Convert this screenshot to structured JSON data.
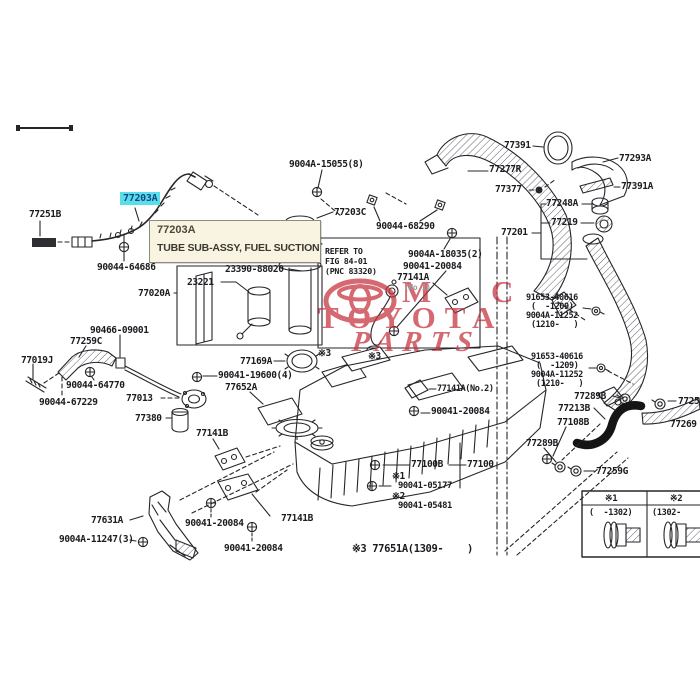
{
  "diagram": {
    "highlight_label": {
      "text": "77203A",
      "bg": "#59dfe8",
      "fg": "#16418f"
    },
    "tooltip": {
      "part_no": "77203A",
      "description": "TUBE SUB-ASSY, FUEL SUCTION"
    },
    "refer_note": [
      "REFER TO",
      "FIG 84-01",
      "(PNC 83320)"
    ],
    "footnote": {
      "marker": "※3",
      "text": " 77651A(1309-    )"
    },
    "watermark": {
      "mc": "M C",
      "toyota": "TOYOTA",
      "parts": "PARTS",
      "color": "#c5303c"
    },
    "ref_table": {
      "headers": [
        "※1",
        "※2"
      ],
      "ranges": [
        "(  -1302)",
        "(1302-"
      ],
      "parts": [
        "bolt-short",
        "bolt-long"
      ]
    },
    "labels": [
      {
        "t": "77251B",
        "x": 29,
        "y": 210
      },
      {
        "t": "90044-64686",
        "x": 97,
        "y": 263
      },
      {
        "t": "23221",
        "x": 187,
        "y": 278
      },
      {
        "t": "23390-88020",
        "x": 225,
        "y": 265
      },
      {
        "t": "77020A",
        "x": 138,
        "y": 289
      },
      {
        "t": "9004A-15055(8)",
        "x": 289,
        "y": 160
      },
      {
        "t": "77203C",
        "x": 334,
        "y": 208
      },
      {
        "t": "90044-68290",
        "x": 376,
        "y": 222
      },
      {
        "t": "9004A-18035(2)",
        "x": 408,
        "y": 250
      },
      {
        "t": "90041-20084",
        "x": 403,
        "y": 262
      },
      {
        "t": "77141A",
        "x": 397,
        "y": 273
      },
      {
        "t": "(No.1)",
        "x": 404,
        "y": 284,
        "fs": 8,
        "c": "#9a9a9a"
      },
      {
        "t": "77391",
        "x": 504,
        "y": 141
      },
      {
        "t": "77277R",
        "x": 489,
        "y": 165
      },
      {
        "t": "77377",
        "x": 495,
        "y": 185
      },
      {
        "t": "77293A",
        "x": 619,
        "y": 154
      },
      {
        "t": "77391A",
        "x": 621,
        "y": 182
      },
      {
        "t": "77248A",
        "x": 546,
        "y": 199
      },
      {
        "t": "77219",
        "x": 551,
        "y": 218
      },
      {
        "t": "77201",
        "x": 501,
        "y": 228
      },
      {
        "t": "91653-40616",
        "x": 526,
        "y": 294,
        "fs": 8.5
      },
      {
        "t": "(  -1209)",
        "x": 531,
        "y": 303,
        "fs": 8.5
      },
      {
        "t": "9004A-11252",
        "x": 526,
        "y": 312,
        "fs": 8.5
      },
      {
        "t": "(1210-   )",
        "x": 531,
        "y": 321,
        "fs": 8.5
      },
      {
        "t": "91653-40616",
        "x": 531,
        "y": 353,
        "fs": 8.5
      },
      {
        "t": "(  -1209)",
        "x": 536,
        "y": 362,
        "fs": 8.5
      },
      {
        "t": "9004A-11252",
        "x": 531,
        "y": 371,
        "fs": 8.5
      },
      {
        "t": "(1210-   )",
        "x": 536,
        "y": 380,
        "fs": 8.5
      },
      {
        "t": "77289B",
        "x": 574,
        "y": 392
      },
      {
        "t": "7725",
        "x": 678,
        "y": 397
      },
      {
        "t": "77213B",
        "x": 558,
        "y": 404
      },
      {
        "t": "77108B",
        "x": 557,
        "y": 418
      },
      {
        "t": "77289B",
        "x": 526,
        "y": 439
      },
      {
        "t": "77259G",
        "x": 596,
        "y": 467
      },
      {
        "t": "77269",
        "x": 670,
        "y": 420
      },
      {
        "t": "77019J",
        "x": 21,
        "y": 356
      },
      {
        "t": "77259C",
        "x": 70,
        "y": 337
      },
      {
        "t": "90466-09001",
        "x": 90,
        "y": 326
      },
      {
        "t": "90044-64770",
        "x": 66,
        "y": 381
      },
      {
        "t": "90044-67229",
        "x": 39,
        "y": 398
      },
      {
        "t": "77013",
        "x": 126,
        "y": 394
      },
      {
        "t": "77380",
        "x": 135,
        "y": 414
      },
      {
        "t": "77169A",
        "x": 240,
        "y": 357
      },
      {
        "t": "90041-19600(4)",
        "x": 218,
        "y": 371
      },
      {
        "t": "77652A",
        "x": 225,
        "y": 383
      },
      {
        "t": "77141B",
        "x": 196,
        "y": 429
      },
      {
        "t": "77141A(No.2)",
        "x": 437,
        "y": 385,
        "fs": 8.5
      },
      {
        "t": "90041-20084",
        "x": 431,
        "y": 407
      },
      {
        "t": "77100B",
        "x": 411,
        "y": 460
      },
      {
        "t": "77100",
        "x": 467,
        "y": 460
      },
      {
        "t": "※1",
        "x": 392,
        "y": 472
      },
      {
        "t": "90041-05177",
        "x": 398,
        "y": 482,
        "fs": 8.8
      },
      {
        "t": "※2",
        "x": 392,
        "y": 492
      },
      {
        "t": "90041-05481",
        "x": 398,
        "y": 502,
        "fs": 8.8
      },
      {
        "t": "※3",
        "x": 318,
        "y": 349
      },
      {
        "t": "※3",
        "x": 368,
        "y": 352
      },
      {
        "t": "77631A",
        "x": 91,
        "y": 516
      },
      {
        "t": "9004A-11247(3)",
        "x": 59,
        "y": 535
      },
      {
        "t": "90041-20084",
        "x": 185,
        "y": 519
      },
      {
        "t": "90041-20084",
        "x": 224,
        "y": 544
      },
      {
        "t": "77141B",
        "x": 281,
        "y": 514
      }
    ]
  }
}
